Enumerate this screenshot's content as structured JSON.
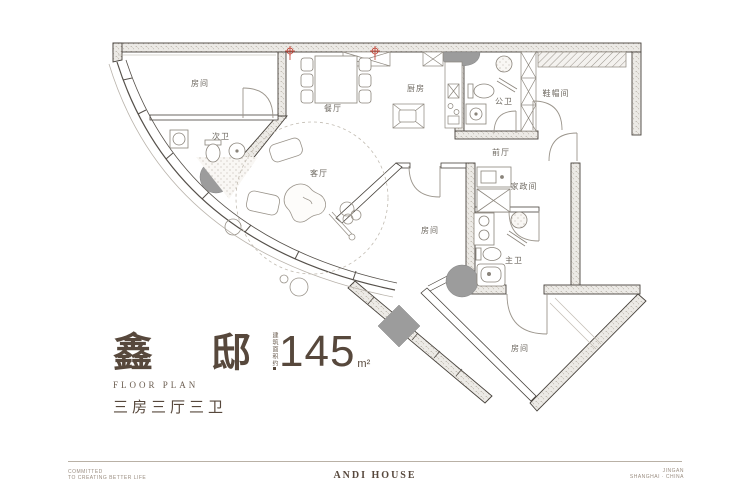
{
  "colors": {
    "accent_brown": "#57483c",
    "wall_line": "#47423c",
    "label_gray": "#6f6a62",
    "column_gray": "#9c9c9c",
    "marker_red": "#c0392b",
    "footer_gray": "#9a8d80"
  },
  "plan": {
    "rooms": [
      {
        "label": "房间"
      },
      {
        "label": "次卫"
      },
      {
        "label": "餐厅"
      },
      {
        "label": "厨房"
      },
      {
        "label": "公卫"
      },
      {
        "label": "鞋帽间"
      },
      {
        "label": "前厅"
      },
      {
        "label": "客厅"
      },
      {
        "label": "家政间"
      },
      {
        "label": "房间"
      },
      {
        "label": "主卫"
      },
      {
        "label": "房间"
      }
    ]
  },
  "title_block": {
    "name": "鑫 邸",
    "subtitle_en": "FLOOR PLAN",
    "layout": "三房三厅三卫",
    "area_prefix": "建筑面积约",
    "area_value": "145",
    "area_unit": "m²"
  },
  "footer": {
    "left_line1": "COMMITTED",
    "left_line2": "TO CREATING BETTER LIFE",
    "center": "ANDI HOUSE",
    "right_line1": "JINGAN",
    "right_line2": "SHANGHAI · CHINA"
  }
}
